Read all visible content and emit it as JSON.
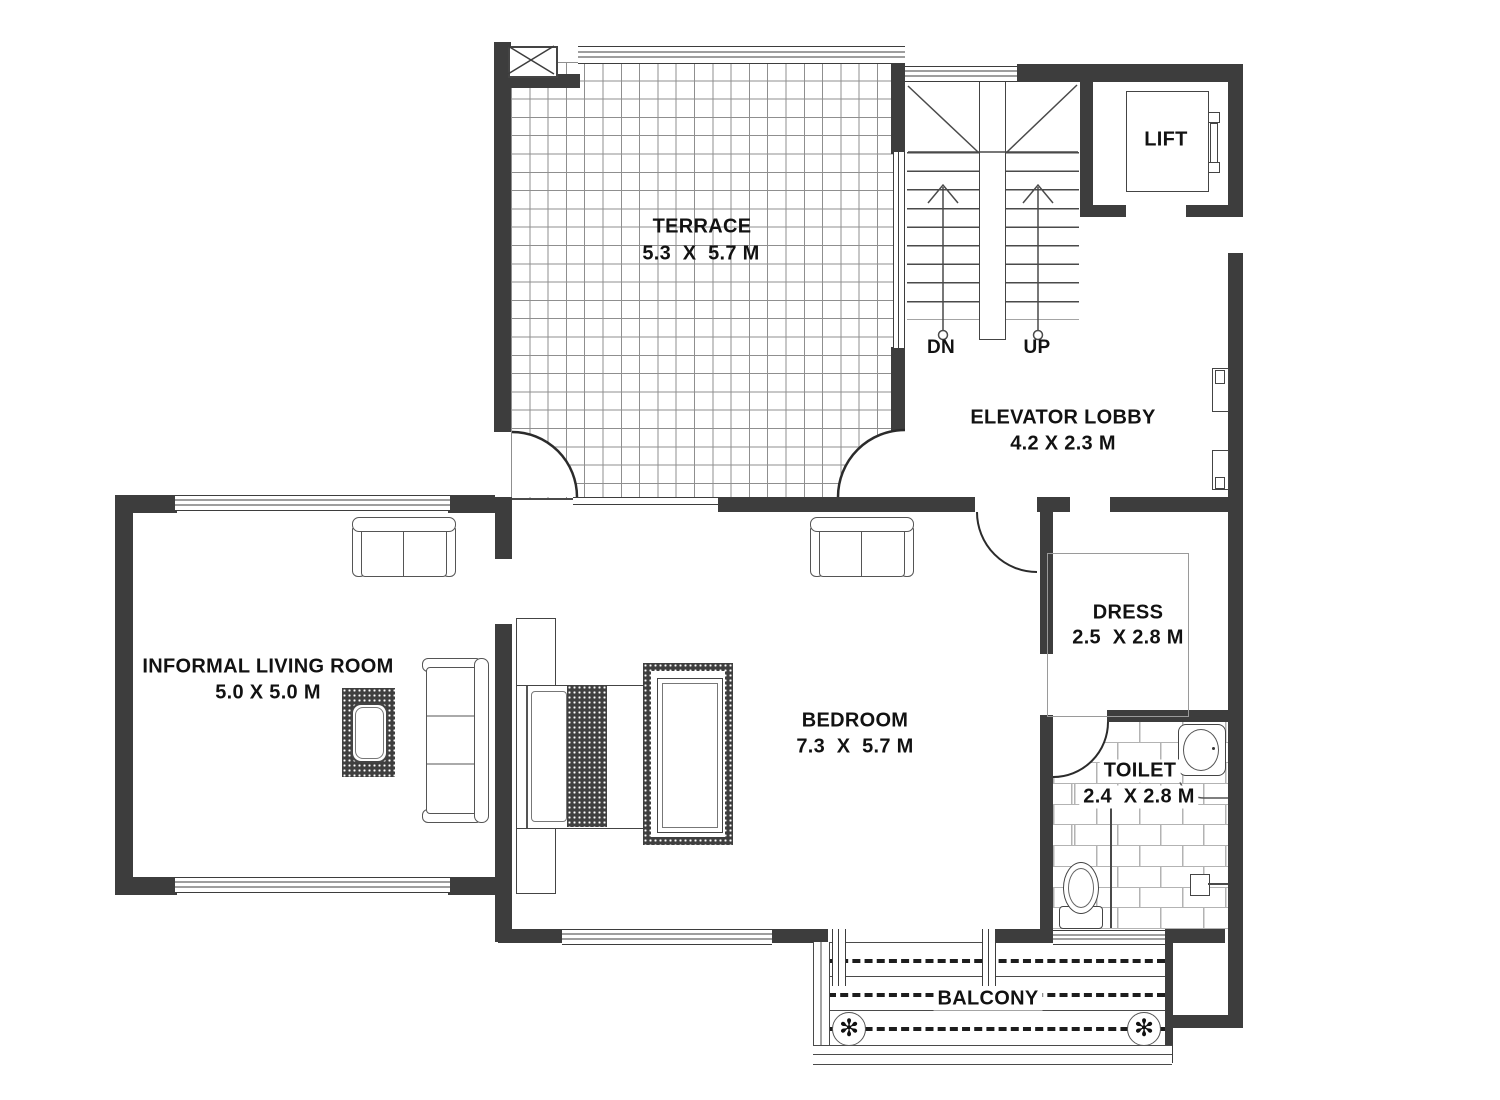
{
  "title": "Floor plan",
  "colors": {
    "wall": "#3d3d3d",
    "line": "#4a4a4a",
    "grid_line": "#8f8f8f",
    "brick_line": "#b3b3b3",
    "text": "#121212",
    "background": "#ffffff"
  },
  "rooms": {
    "terrace": {
      "name": "TERRACE",
      "dims": "5.3  X  5.7 M"
    },
    "elevator_lobby": {
      "name": "ELEVATOR LOBBY",
      "dims": "4.2 X 2.3 M"
    },
    "lift": {
      "name": "LIFT"
    },
    "dress": {
      "name": "DRESS",
      "dims": "2.5  X 2.8 M"
    },
    "toilet": {
      "name": "TOILET",
      "dims": "2.4  X 2.8 M"
    },
    "bedroom": {
      "name": "BEDROOM",
      "dims": "7.3  X  5.7 M"
    },
    "living_room": {
      "name": "INFORMAL LIVING ROOM",
      "dims": "5.0 X 5.0 M"
    },
    "balcony": {
      "name": "BALCONY"
    }
  },
  "stairs": {
    "down": "DN",
    "up": "UP"
  },
  "icons": {
    "plant": "✻"
  }
}
